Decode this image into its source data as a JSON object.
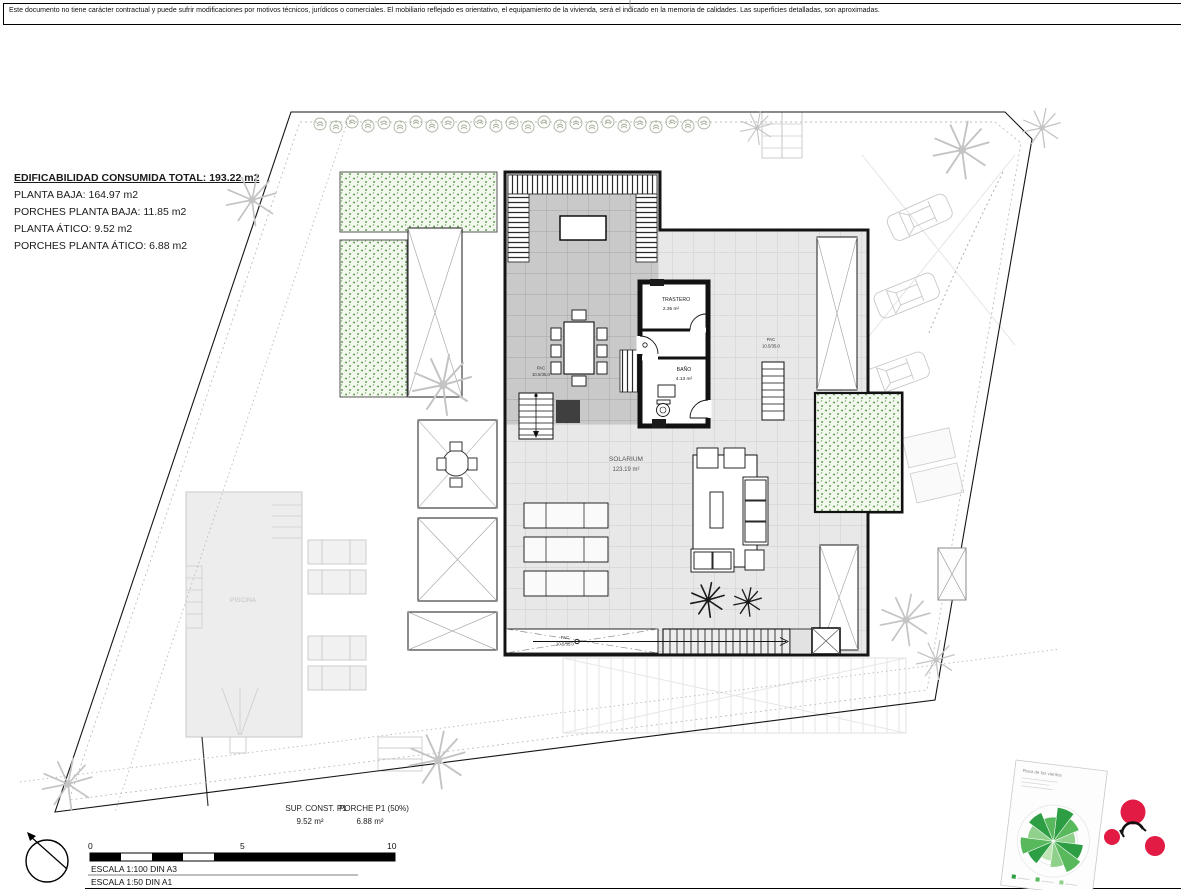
{
  "page": {
    "disclaimer": "Este documento no tiene carácter contractual y puede sufrir modificaciones por motivos técnicos, jurídicos o comerciales. El mobiliario reflejado es orientativo, el equipamiento de la vivienda, será el indicado en la memoria de calidades. Las superficies detalladas, son aproximadas."
  },
  "info": {
    "title": "EDIFICABILIDAD CONSUMIDA TOTAL: 193.22 m2",
    "lines": [
      "PLANTA BAJA: 164.97 m2",
      "PORCHES PLANTA BAJA: 11.85 m2",
      "PLANTA ÁTICO: 9.52 m2",
      "PORCHES PLANTA ÁTICO: 6.88 m2"
    ]
  },
  "plan": {
    "trastero": {
      "name": "TRASTERO",
      "area": "2.35 m²"
    },
    "bano": {
      "name": "BAÑO",
      "area": "4.13 m²"
    },
    "solarium": {
      "name": "SOLARIUM",
      "area": "123.19 m²"
    },
    "piscina": {
      "name": "PISCINA"
    },
    "ac_label": {
      "line1": "PAC",
      "line2": "10.5/35.0"
    }
  },
  "summary": {
    "col1_label": "SUP. CONST. P1",
    "col1_value": "9.52 m²",
    "col2_label": "PORCHE P1 (50%)",
    "col2_value": "6.88 m²"
  },
  "scalebar": {
    "tick_0": "0",
    "tick_5": "5",
    "tick_10": "10",
    "escala_a3": "ESCALA 1:100 DIN A3",
    "escala_a1": "ESCALA 1:50 DIN A1"
  },
  "inset": {
    "title": "Rosa de los vientos"
  },
  "colors": {
    "paper": "#ffffff",
    "line": "#141414",
    "deck_light": "#e8e8e8",
    "deck_medium": "#c9c9c9",
    "grid_light": "#cccccc",
    "grid_medium": "#a6a6a6",
    "green_dot": "#61a050",
    "faint_gray": "#c9c9c9",
    "logo_red": "#e11b44",
    "rose_green": "#2e9e44"
  }
}
